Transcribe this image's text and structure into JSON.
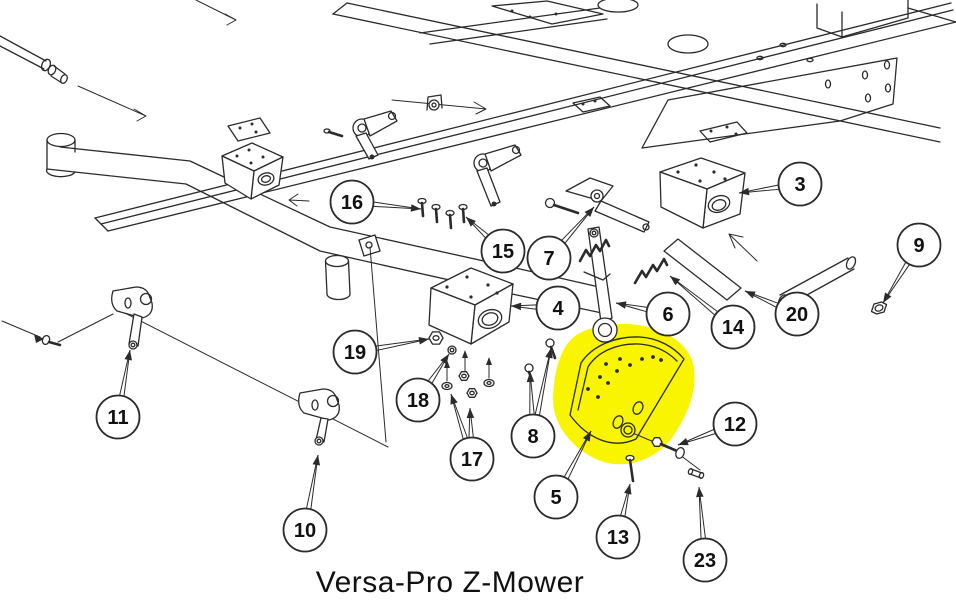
{
  "diagram": {
    "caption": "Versa-Pro Z-Mower",
    "highlighted_part_balloon": "5",
    "colors": {
      "line": "#2b2b2b",
      "highlight": "#f9f400",
      "background": "#ffffff",
      "text": "#111111",
      "balloon_fill": "#ffffff"
    },
    "balloons": [
      {
        "label": "16",
        "x": 352,
        "y": 202,
        "targets": [
          [
            421,
            209
          ]
        ]
      },
      {
        "label": "15",
        "x": 503,
        "y": 251,
        "targets": [
          [
            466,
            217
          ]
        ]
      },
      {
        "label": "7",
        "x": 549,
        "y": 258,
        "targets": [
          [
            594,
            207
          ]
        ]
      },
      {
        "label": "3",
        "x": 800,
        "y": 184,
        "targets": [
          [
            739,
            193
          ]
        ]
      },
      {
        "label": "9",
        "x": 919,
        "y": 245,
        "targets": [
          [
            883,
            303
          ]
        ]
      },
      {
        "label": "4",
        "x": 558,
        "y": 308,
        "targets": [
          [
            511,
            306
          ]
        ]
      },
      {
        "label": "6",
        "x": 668,
        "y": 314,
        "targets": [
          [
            616,
            303
          ]
        ]
      },
      {
        "label": "14",
        "x": 733,
        "y": 327,
        "targets": [
          [
            670,
            276
          ]
        ]
      },
      {
        "label": "20",
        "x": 797,
        "y": 314,
        "targets": [
          [
            745,
            291
          ]
        ]
      },
      {
        "label": "19",
        "x": 355,
        "y": 352,
        "targets": [
          [
            429,
            339
          ]
        ]
      },
      {
        "label": "18",
        "x": 418,
        "y": 400,
        "targets": [
          [
            449,
            354
          ]
        ]
      },
      {
        "label": "17",
        "x": 472,
        "y": 459,
        "targets": [
          [
            451,
            394
          ],
          [
            470,
            408
          ]
        ]
      },
      {
        "label": "8",
        "x": 533,
        "y": 436,
        "targets": [
          [
            530,
            372
          ],
          [
            551,
            348
          ]
        ]
      },
      {
        "label": "11",
        "x": 118,
        "y": 417,
        "targets": [
          [
            130,
            350
          ]
        ]
      },
      {
        "label": "10",
        "x": 305,
        "y": 530,
        "targets": [
          [
            318,
            455
          ]
        ]
      },
      {
        "label": "5",
        "x": 556,
        "y": 497,
        "targets": [
          [
            591,
            431
          ]
        ]
      },
      {
        "label": "12",
        "x": 735,
        "y": 424,
        "targets": [
          [
            678,
            445
          ]
        ]
      },
      {
        "label": "13",
        "x": 618,
        "y": 537,
        "targets": [
          [
            630,
            484
          ]
        ]
      },
      {
        "label": "23",
        "x": 705,
        "y": 560,
        "targets": [
          [
            699,
            487
          ]
        ]
      }
    ]
  }
}
